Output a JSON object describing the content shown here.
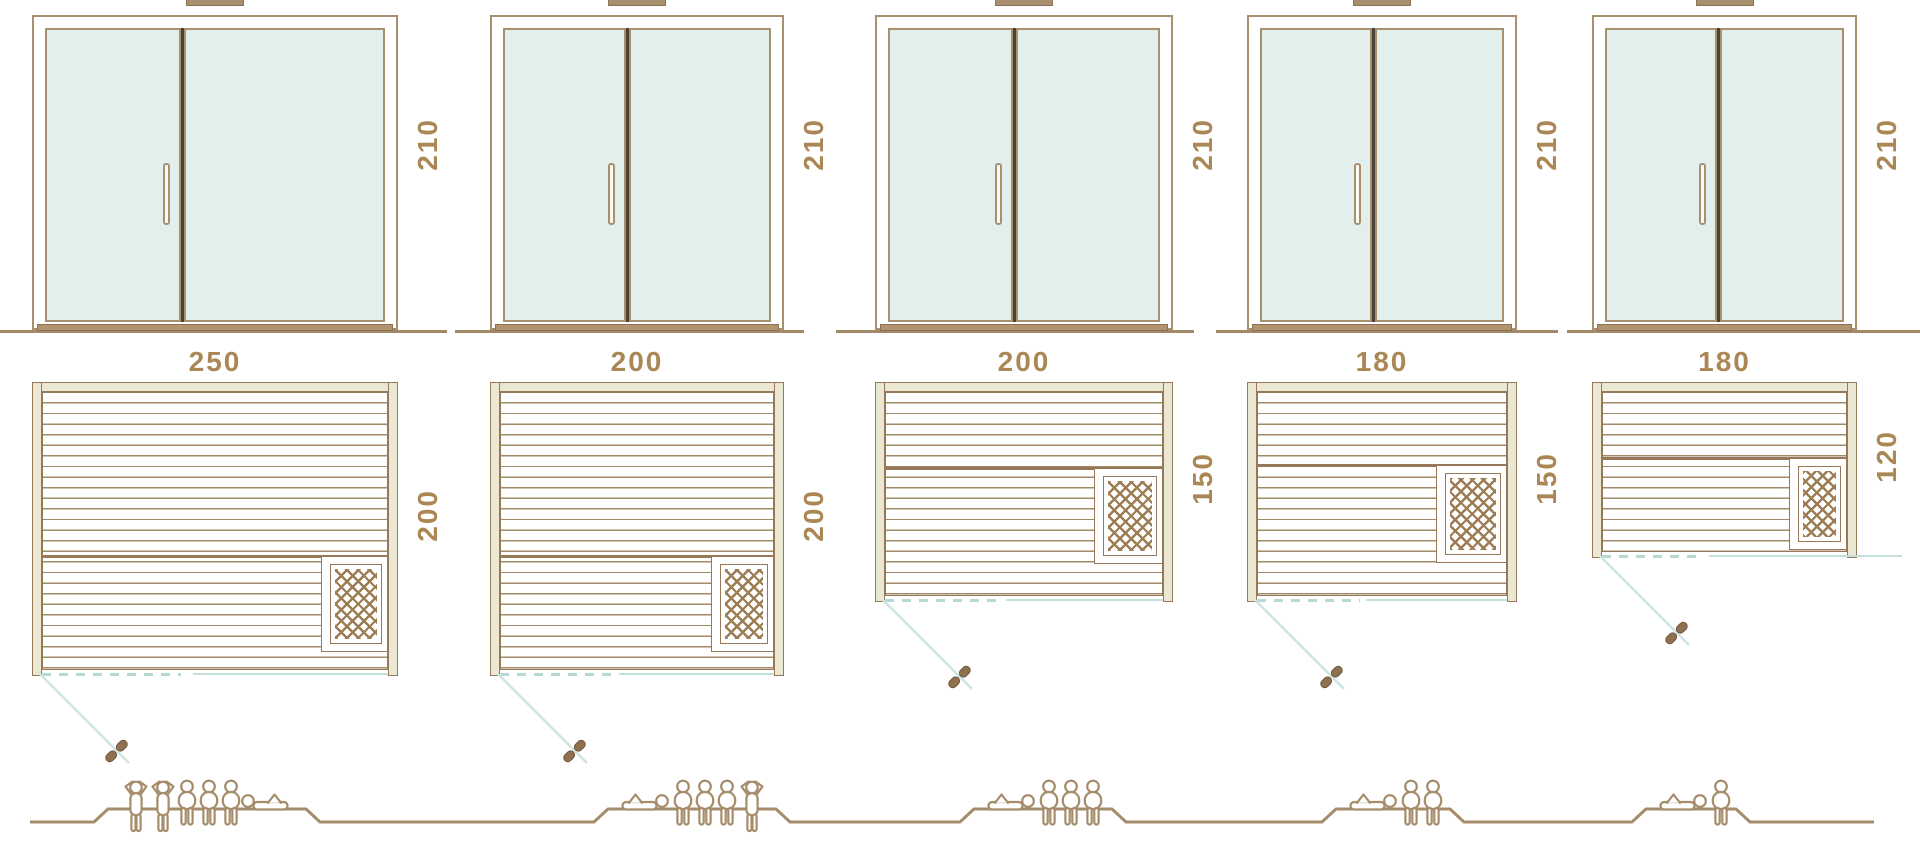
{
  "diagram_title": "Sauna size comparison diagram",
  "saunas": [
    {
      "name": "sauna-250x200",
      "door_height": "210",
      "width": "250",
      "depth": "200",
      "capacity": {
        "standing": 2,
        "seated": 3,
        "reclining": 1,
        "total": 6
      }
    },
    {
      "name": "sauna-200x200",
      "door_height": "210",
      "width": "200",
      "depth": "200",
      "capacity": {
        "standing": 1,
        "seated": 3,
        "reclining": 1,
        "total": 5
      }
    },
    {
      "name": "sauna-200x150",
      "door_height": "210",
      "width": "200",
      "depth": "150",
      "capacity": {
        "standing": 0,
        "seated": 3,
        "reclining": 1,
        "total": 4
      }
    },
    {
      "name": "sauna-180x150",
      "door_height": "210",
      "width": "180",
      "depth": "150",
      "capacity": {
        "standing": 0,
        "seated": 2,
        "reclining": 1,
        "total": 3
      }
    },
    {
      "name": "sauna-180x120",
      "door_height": "210",
      "width": "180",
      "depth": "120",
      "capacity": {
        "standing": 0,
        "seated": 1,
        "reclining": 1,
        "total": 2
      }
    }
  ],
  "colors": {
    "line": "#a58c6b",
    "wall_fill": "#eae7d3",
    "glass": "#e2efec",
    "teal": "#bcdcd8",
    "dimension_text": "#ab8755",
    "door_divider": "#4a4238",
    "heater_hatch": "#9c7c53"
  }
}
